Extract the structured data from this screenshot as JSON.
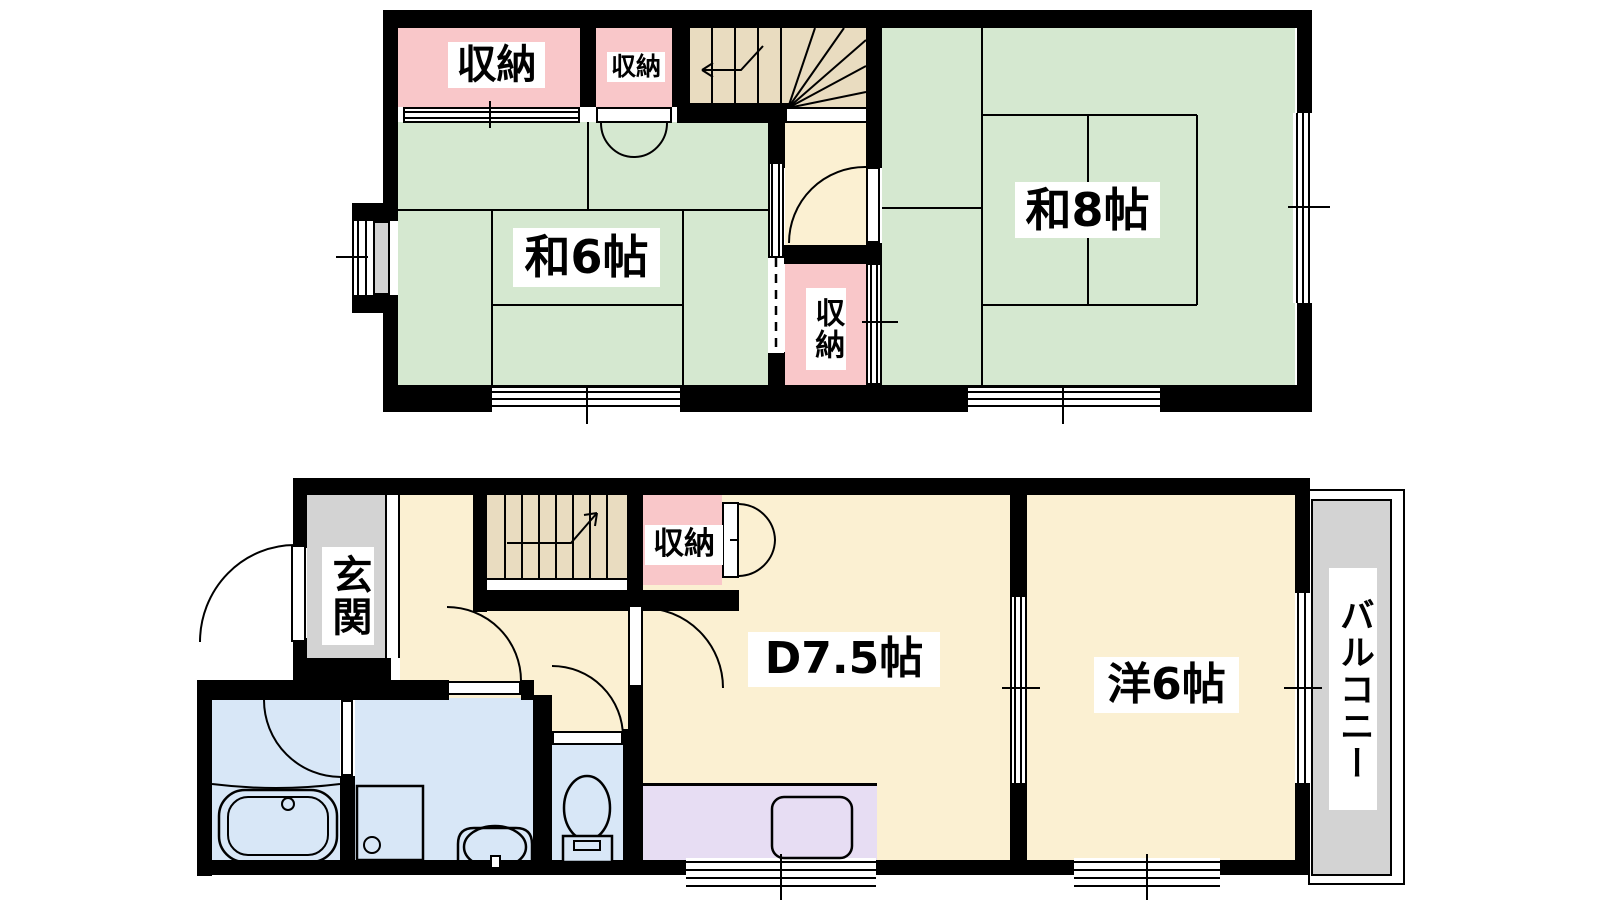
{
  "meta": {
    "type": "floor-plan",
    "language": "ja"
  },
  "colors": {
    "wall": "#000000",
    "tatami_room": "#d5e8d0",
    "flooring_room": "#fbf0d2",
    "stairs": "#e9dcc0",
    "closet": "#f9c7c9",
    "entrance_gray": "#d3d3d3",
    "balcony_gray": "#d3d3d3",
    "wet_area_blue": "#d8e7f7",
    "kitchen_purple": "#e7ddf3"
  },
  "upper_floor": {
    "closet_top_left": "収納",
    "closet_top_small": "収納",
    "japanese_room_6": "和6帖",
    "japanese_room_8": "和8帖",
    "closet_middle": "収納"
  },
  "lower_floor": {
    "entrance": "玄関",
    "closet": "収納",
    "dining": "D7.5帖",
    "western_room_6": "洋6帖",
    "balcony": "バルコニー"
  }
}
